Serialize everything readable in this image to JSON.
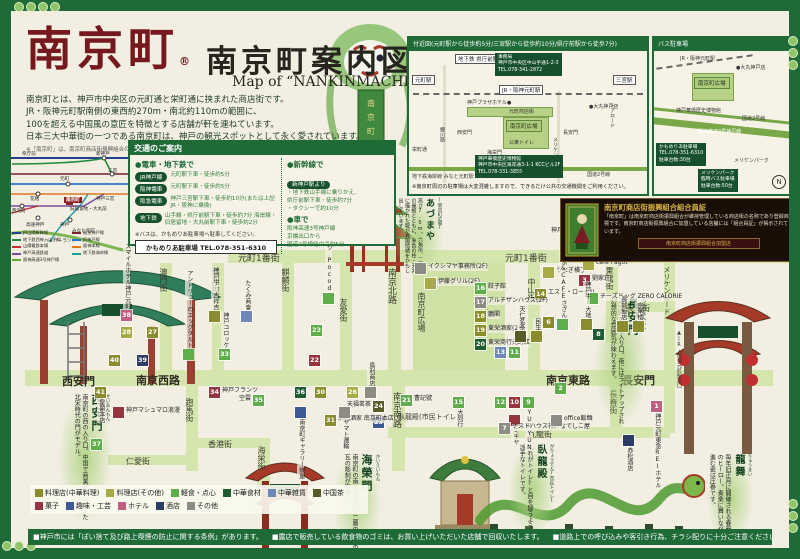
{
  "page": {
    "logo": "南京町",
    "reg": "®",
    "title": "南京町案内図",
    "subtitle": "Map of “NANKINMACHI”area",
    "description": [
      "南京町とは、神戸市中央区の元町通と栄町通に挟まれた商店街です。",
      "JR・阪神元町駅南側の東西約270m・南北約110mの範囲に、",
      "100を超える中国風の意匠を特徴とする店舗が軒を連ねています。",
      "日本三大中華街の一つである南京町は、神戸の観光スポットとして永く愛されています。"
    ],
    "footnote": "※「南京町」は、南京町商店街振興組合の登録商標です。"
  },
  "category_colors": {
    "chinese": "#8a8c2e",
    "other": "#a8aa48",
    "snack": "#5fae4b",
    "food": "#1f5c31",
    "goods": "#6f86b8",
    "tea": "#5a5c28",
    "sweets": "#963440",
    "hobby": "#3c5a96",
    "hotel": "#c06080",
    "liquor": "#2c3c64",
    "misc": "#8c8c84"
  },
  "vicinity": {
    "title": "付近図(元町駅から徒歩約5分/三宮駅から徒歩約10分/県庁前駅から徒歩7分)",
    "labels": [
      {
        "t": "地下鉄 県庁前駅",
        "x": 46,
        "y": 3,
        "cls": "boxw"
      },
      {
        "t": "元町駅",
        "x": 3,
        "y": 24,
        "cls": "boxw"
      },
      {
        "t": "三宮駅",
        "x": 204,
        "y": 24,
        "cls": "boxw"
      },
      {
        "t": "事務局\n神戸市中央区中山手通1-2-3\nTEL.078-341-2872",
        "x": 86,
        "y": 2,
        "cls": "darkbox"
      },
      {
        "t": "JR・阪神元町駅",
        "x": 90,
        "y": 34,
        "cls": "boxw"
      },
      {
        "t": "神戸プラザホテル●",
        "x": 58,
        "y": 48,
        "cls": "plain6"
      },
      {
        "t": "元町商店街",
        "x": 100,
        "y": 57,
        "cls": "plain6"
      },
      {
        "t": "●大丸神戸店",
        "x": 180,
        "y": 52,
        "cls": "plain6"
      },
      {
        "t": "西安門",
        "x": 48,
        "y": 78,
        "cls": "plain6"
      },
      {
        "t": "南京町広場",
        "x": 97,
        "y": 69,
        "cls": "greenbox"
      },
      {
        "t": "長安門",
        "x": 154,
        "y": 78,
        "cls": "plain6"
      },
      {
        "t": "公衆トイレ",
        "x": 100,
        "y": 88,
        "cls": "plain6"
      },
      {
        "t": "海栄門",
        "x": 78,
        "y": 98,
        "cls": "plain6"
      },
      {
        "t": "鯉川筋",
        "x": 30,
        "y": 76,
        "cls": "plain6",
        "v": 1
      },
      {
        "t": "メリケンロード",
        "x": 143,
        "y": 86,
        "cls": "plain6",
        "v": 1
      },
      {
        "t": "トアロード",
        "x": 200,
        "y": 52,
        "cls": "plain6",
        "v": 1
      },
      {
        "t": "栄町通",
        "x": 3,
        "y": 95,
        "cls": "plain6"
      },
      {
        "t": "地下鉄海岸線 みなと元町駅",
        "x": 3,
        "y": 122,
        "cls": "plain6"
      },
      {
        "t": "神戸華僑歴史博物館\n神戸市中央区海岸通3-1-1 KCCビル2F\nTEL.078-331-3855",
        "x": 66,
        "y": 104,
        "cls": "darkbox"
      },
      {
        "t": "国道2号線",
        "x": 178,
        "y": 120,
        "cls": "plain6"
      },
      {
        "t": "※南京町周辺の駐車場は大変混雑しますので、できるだけ公共の交通機関をご利用ください。",
        "x": 3,
        "y": 132,
        "cls": "note"
      }
    ]
  },
  "bus": {
    "title": "バス駐車場",
    "labels": [
      {
        "t": "JR・阪神元町駅",
        "x": 26,
        "y": 4,
        "cls": "plain6"
      },
      {
        "t": "●大丸神戸店",
        "x": 82,
        "y": 13,
        "cls": "plain6"
      },
      {
        "t": "南京町広場",
        "x": 40,
        "y": 26,
        "cls": "greenbox"
      },
      {
        "t": "神戸華僑歴史博物館",
        "x": 22,
        "y": 56,
        "cls": "plain6"
      },
      {
        "t": "国道2号線",
        "x": 88,
        "y": 64,
        "cls": "plain6"
      },
      {
        "t": "阪神高速3号神戸線",
        "x": 44,
        "y": 77,
        "cls": "bandlabel"
      },
      {
        "t": "かもめりあ駐車場\nTEL.078-351-6310\n駐車台数:30台",
        "x": 2,
        "y": 92,
        "cls": "darkbox"
      },
      {
        "t": "メリケンパーク",
        "x": 80,
        "y": 106,
        "cls": "plain6"
      },
      {
        "t": "メリケンパーク\n臨時バス駐車場\n駐車台数:50台",
        "x": 44,
        "y": 118,
        "cls": "darkbox"
      },
      {
        "t": "N",
        "x": 118,
        "y": 124,
        "cls": "compass"
      }
    ]
  },
  "transit": {
    "stations": [
      {
        "t": "県庁前",
        "x": 14,
        "y": 1
      },
      {
        "t": "新神戸",
        "x": 88,
        "y": 1
      },
      {
        "t": "三宮",
        "x": 100,
        "y": 18
      },
      {
        "t": "元町",
        "x": 52,
        "y": 26
      },
      {
        "t": "神戸三宮",
        "x": 88,
        "y": 46
      },
      {
        "t": "旧居留地・大丸前",
        "x": 62,
        "y": 56
      },
      {
        "t": "花隈",
        "x": 22,
        "y": 46
      },
      {
        "t": "西元町",
        "x": 4,
        "y": 58
      },
      {
        "t": "高速神戸",
        "x": 18,
        "y": 72
      },
      {
        "t": "神戸",
        "x": 52,
        "y": 72
      },
      {
        "t": "みなと元町",
        "x": 64,
        "y": 78
      },
      {
        "t": "ハーバーランド",
        "x": 36,
        "y": 88
      },
      {
        "t": "南京町",
        "x": 56,
        "y": 47,
        "red": 1
      }
    ],
    "legend": [
      {
        "c": "#24408e",
        "t": "JR山陽新幹線"
      },
      {
        "c": "#7a2030",
        "t": "阪急神戸線"
      },
      {
        "c": "#1e8a3c",
        "t": "地下鉄西神・山手線"
      },
      {
        "c": "#2878c8",
        "t": "JR神戸線"
      },
      {
        "c": "#c03030",
        "t": "山陽電鉄本線"
      },
      {
        "c": "#e07820",
        "t": "阪神本線"
      },
      {
        "c": "#7a4a9a",
        "t": "神戸高速鉄道"
      },
      {
        "c": "#18a0a0",
        "t": "地下鉄海岸線"
      },
      {
        "c": "#60a830",
        "t": "阪神高速3号神戸線"
      }
    ]
  },
  "transport": {
    "title": "交通のご案内",
    "train_header": "●電車・地下鉄で",
    "train_rows": [
      {
        "badge": "JR神戸線",
        "text": "元町駅下車・徒歩約5分"
      },
      {
        "badge": "阪神電車",
        "text": "元町駅下車・徒歩約5分"
      },
      {
        "badge": "阪急電車",
        "text": "神戸三宮駅下車・徒歩約10分(または上記JR・阪神に乗換)"
      },
      {
        "badge": "地下鉄",
        "text": "山手線・県庁前駅下車・徒歩約7分 海岸線・旧居留地・大丸前駅下車・徒歩約2分"
      }
    ],
    "bus_note": "※バスは、かもめりあ駐車場へ駐車してください。",
    "kamomeria": "かもめりあ駐車場 TEL.078-351-6310",
    "shinkansen_header": "●新幹線で",
    "shinkansen_badge": "新神戸駅より",
    "shinkansen_lines": [
      "・地下鉄山手線に乗りかえ、",
      "  県庁前駅下車・徒歩約7分",
      "・タクシーで約10分"
    ],
    "car_header": "●車で",
    "car_lines": [
      "阪神高速3号神戸線",
      "京橋出口から",
      "国道2号線経由で約5分"
    ]
  },
  "member": {
    "title": "南京町商店街振興組合組合員証",
    "body": "「南京町」は南京町商店街振興組合が維持管理している商店街の名称であり登録商標です。南京町商店街振興組合に加盟している店舗には「組合員証」が掲示されています。",
    "plaque": "南京町商店街振興組合加盟店"
  },
  "map": {
    "street_color": "#d5e5ae",
    "streets": [
      {
        "x": 228,
        "y": 250,
        "w": 566,
        "h": 13
      },
      {
        "x": 25,
        "y": 370,
        "w": 748,
        "h": 16
      },
      {
        "x": 388,
        "y": 427,
        "w": 282,
        "h": 11
      },
      {
        "x": 160,
        "y": 263,
        "w": 12,
        "h": 107
      },
      {
        "x": 212,
        "y": 263,
        "w": 12,
        "h": 107
      },
      {
        "x": 282,
        "y": 263,
        "w": 12,
        "h": 107
      },
      {
        "x": 340,
        "y": 263,
        "w": 12,
        "h": 107
      },
      {
        "x": 388,
        "y": 263,
        "w": 13,
        "h": 107
      },
      {
        "x": 528,
        "y": 263,
        "w": 12,
        "h": 107
      },
      {
        "x": 606,
        "y": 263,
        "w": 12,
        "h": 80
      },
      {
        "x": 618,
        "y": 302,
        "w": 52,
        "h": 10
      },
      {
        "x": 664,
        "y": 263,
        "w": 11,
        "h": 170
      },
      {
        "x": 392,
        "y": 386,
        "w": 13,
        "h": 85
      },
      {
        "x": 610,
        "y": 386,
        "w": 12,
        "h": 41
      },
      {
        "x": 186,
        "y": 386,
        "w": 12,
        "h": 85
      },
      {
        "x": 258,
        "y": 438,
        "w": 12,
        "h": 55
      },
      {
        "x": 108,
        "y": 455,
        "w": 78,
        "h": 10
      },
      {
        "x": 198,
        "y": 438,
        "w": 60,
        "h": 10
      }
    ],
    "street_labels": [
      {
        "t": "元町1番街",
        "x": 238,
        "y": 251,
        "s": 9
      },
      {
        "t": "元町1番街",
        "x": 505,
        "y": 251,
        "s": 9
      },
      {
        "t": "澳門街",
        "x": 158,
        "y": 268,
        "v": 1,
        "s": 8
      },
      {
        "t": "珠海街",
        "x": 210,
        "y": 268,
        "v": 1,
        "s": 8
      },
      {
        "t": "麒麟街",
        "x": 280,
        "y": 268,
        "v": 1,
        "s": 8
      },
      {
        "t": "友愛街",
        "x": 338,
        "y": 298,
        "v": 1,
        "s": 8
      },
      {
        "t": "南京北路",
        "x": 385,
        "y": 268,
        "v": 1,
        "s": 9
      },
      {
        "t": "南京町広場",
        "x": 416,
        "y": 292,
        "v": 1,
        "s": 8
      },
      {
        "t": "中山街",
        "x": 526,
        "y": 278,
        "v": 1,
        "s": 8
      },
      {
        "t": "東龍街",
        "x": 604,
        "y": 266,
        "v": 1,
        "s": 8
      },
      {
        "t": "長城街",
        "x": 626,
        "y": 303,
        "s": 8
      },
      {
        "t": "メリケンロード",
        "x": 662,
        "y": 266,
        "v": 1,
        "s": 7
      },
      {
        "t": "西安門",
        "x": 62,
        "y": 373,
        "s": 11,
        "b": 1
      },
      {
        "t": "南京西路",
        "x": 136,
        "y": 372,
        "s": 11,
        "b": 1
      },
      {
        "t": "南京東路",
        "x": 546,
        "y": 372,
        "s": 11,
        "b": 1
      },
      {
        "t": "長安門",
        "x": 622,
        "y": 372,
        "s": 11,
        "b": 1
      },
      {
        "t": "南京南路",
        "x": 390,
        "y": 392,
        "v": 1,
        "s": 9
      },
      {
        "t": "九龍街",
        "x": 528,
        "y": 429,
        "s": 8
      },
      {
        "t": "長春街",
        "x": 608,
        "y": 390,
        "v": 1,
        "s": 8
      },
      {
        "t": "跑馬街",
        "x": 184,
        "y": 398,
        "v": 1,
        "s": 8
      },
      {
        "t": "仁愛街",
        "x": 126,
        "y": 456,
        "s": 8
      },
      {
        "t": "香港街",
        "x": 208,
        "y": 439,
        "s": 8
      },
      {
        "t": "海栄街",
        "x": 256,
        "y": 446,
        "v": 1,
        "s": 8
      },
      {
        "t": "臥龍殿(市民トイレ)",
        "x": 398,
        "y": 412,
        "s": 7
      },
      {
        "t": "▲JR・阪神元町駅東口",
        "x": 676,
        "y": 330,
        "v": 1,
        "s": 5
      },
      {
        "t": "海栄門",
        "x": 400,
        "y": 533,
        "s": 9
      }
    ],
    "gates": [
      {
        "kana": "せいあんもん",
        "name": "西安門",
        "desc": "南京町の西の入り口。中国で商業が最も栄えた北宋時代の門がモデル。"
      },
      {
        "kana": "ちょうあんもん",
        "name": "長安門",
        "desc": "南京町の東の入り口。夜にはライトアップされ幻想的な雰囲気が味わえます。"
      },
      {
        "kana": "かいえいもん",
        "name": "海榮門",
        "desc": "南京町の南の入り口。二層の屋根の瓦の彫刻が豪華!"
      },
      {
        "kana": "(南京町広場)",
        "name": "あづまや",
        "desc": "高さ7.5m。六角形、二層式の屋根とともに、朱色の柱・天井に描かれた龍が異国情緒をかもし出しています。"
      },
      {
        "kana": "がりょうでん(市民トイレ)",
        "name": "臥龍殿",
        "desc": "これがトイレ?と目を疑うような派手なトイレです。"
      },
      {
        "kana": "りゅうまい",
        "name": "龍舞",
        "desc": "毎年旧正月に開催される春節祭のヒーロー。奏楽に舞いながら進む姿は圧巻です。"
      }
    ],
    "markers": [
      {
        "n": "38",
        "c": "hotel",
        "x": 126,
        "y": 315,
        "t": "スマイルホテル神戸元町",
        "p": "up"
      },
      {
        "c": "chinese",
        "x": 214,
        "y": 316,
        "t": "神戸牛 吉祥吉",
        "p": "up"
      },
      {
        "c": "goods",
        "x": 246,
        "y": 316,
        "t": "たくみ商會",
        "p": "up"
      },
      {
        "n": "27",
        "c": "chinese",
        "x": 152,
        "y": 332
      },
      {
        "n": "28",
        "c": "other",
        "x": 126,
        "y": 332
      },
      {
        "n": "33",
        "c": "snack",
        "x": 224,
        "y": 354,
        "t": "神戸コロッケ",
        "p": "up"
      },
      {
        "c": "snack",
        "x": 188,
        "y": 354,
        "t": "アンドリューのエッグタルト",
        "p": "up"
      },
      {
        "n": "40",
        "c": "chinese",
        "x": 114,
        "y": 360
      },
      {
        "n": "39",
        "c": "liquor",
        "x": 142,
        "y": 360
      },
      {
        "n": "23",
        "c": "snack",
        "x": 316,
        "y": 330
      },
      {
        "c": "snack",
        "x": 328,
        "y": 298,
        "t": "チーズドッグ Pocod",
        "p": "up"
      },
      {
        "n": "22",
        "c": "sweets",
        "x": 314,
        "y": 360
      },
      {
        "c": "misc",
        "x": 420,
        "y": 268,
        "t": "イクシマヤ事務所(2F)",
        "p": "right"
      },
      {
        "c": "other",
        "x": 430,
        "y": 283,
        "t": "伊藤グリル(2F)",
        "p": "right"
      },
      {
        "c": "other",
        "x": 548,
        "y": 272,
        "t": "うなぎ横丁",
        "p": "right"
      },
      {
        "c": "other",
        "x": 588,
        "y": 264,
        "t": "cafe Pagot",
        "p": "right"
      },
      {
        "n": "3",
        "c": "sweets",
        "x": 584,
        "y": 280,
        "t": "劉家荘",
        "p": "right"
      },
      {
        "n": "5",
        "c": "hotel",
        "x": 606,
        "y": 232,
        "t": "神戸プラザホテル",
        "p": "left"
      },
      {
        "n": "14",
        "c": "chinese",
        "x": 540,
        "y": 294,
        "t": "エスト・ローゼル",
        "p": "right"
      },
      {
        "n": "16",
        "c": "snack",
        "x": 480,
        "y": 288,
        "t": "餃子館",
        "p": "right"
      },
      {
        "n": "17",
        "c": "misc",
        "x": 480,
        "y": 302,
        "t": "アルチザンハウス(2F)",
        "p": "right"
      },
      {
        "n": "18",
        "c": "chinese",
        "x": 480,
        "y": 316,
        "t": "鵬閣",
        "p": "right"
      },
      {
        "n": "19",
        "c": "chinese",
        "x": 480,
        "y": 330,
        "t": "東栄酒家(2F)",
        "p": "right"
      },
      {
        "n": "20",
        "c": "food",
        "x": 480,
        "y": 344,
        "t": "東栄商行元町店",
        "p": "right"
      },
      {
        "c": "tea",
        "x": 520,
        "y": 336,
        "t": "天仁茗茶",
        "p": "up"
      },
      {
        "c": "chinese",
        "x": 536,
        "y": 336,
        "t": "民生",
        "p": "up"
      },
      {
        "n": "13",
        "c": "goods",
        "x": 500,
        "y": 352
      },
      {
        "n": "11",
        "c": "snack",
        "x": 514,
        "y": 352
      },
      {
        "n": "8",
        "c": "food",
        "x": 598,
        "y": 334
      },
      {
        "n": "6",
        "c": "chinese",
        "x": 548,
        "y": 322
      },
      {
        "c": "snack",
        "x": 562,
        "y": 324,
        "t": "かき氷&CAFEさざん",
        "p": "up"
      },
      {
        "c": "snack",
        "x": 592,
        "y": 298,
        "t": "チーズドッグ ZERO CALORIE",
        "p": "right"
      },
      {
        "c": "chinese",
        "x": 586,
        "y": 324,
        "t": "神戸牛 大地",
        "p": "up"
      },
      {
        "c": "chinese",
        "x": 622,
        "y": 326,
        "t": "長城飯店",
        "p": "up"
      },
      {
        "c": "chinese",
        "x": 638,
        "y": 326,
        "t": "京華楼",
        "p": "up"
      },
      {
        "n": "2",
        "c": "snack",
        "x": 560,
        "y": 388
      },
      {
        "n": "1",
        "c": "hotel",
        "x": 656,
        "y": 406,
        "t": "神戸元町東急REIホテル",
        "p": "down"
      },
      {
        "n": "21",
        "c": "snack",
        "x": 406,
        "y": 400,
        "t": "曹記號",
        "p": "right"
      },
      {
        "n": "15",
        "c": "snack",
        "x": 458,
        "y": 402,
        "t": "大同行",
        "p": "down"
      },
      {
        "n": "12",
        "c": "snack",
        "x": 500,
        "y": 402
      },
      {
        "n": "10",
        "c": "sweets",
        "x": 514,
        "y": 402
      },
      {
        "n": "9",
        "c": "snack",
        "x": 528,
        "y": 402,
        "t": "YUNYUN",
        "p": "down"
      },
      {
        "c": "sweets",
        "x": 514,
        "y": 420,
        "t": "ミキヤ",
        "p": "down"
      },
      {
        "n": "24",
        "c": "tea",
        "x": 378,
        "y": 406,
        "t": "天福茗茶",
        "p": "left"
      },
      {
        "n": "25",
        "c": "hobby",
        "x": 378,
        "y": 422
      },
      {
        "n": "34",
        "c": "sweets",
        "x": 214,
        "y": 392,
        "t": "神戸フランツ",
        "p": "right"
      },
      {
        "n": "41",
        "c": "chinese",
        "x": 100,
        "y": 392,
        "t": "皇蘭本店",
        "p": "down"
      },
      {
        "c": "sweets",
        "x": 118,
        "y": 412,
        "t": "神戸マシュマロ浪漫",
        "p": "right"
      },
      {
        "n": "35",
        "c": "snack",
        "x": 258,
        "y": 400,
        "t": "空雲",
        "p": "left"
      },
      {
        "n": "36",
        "c": "food",
        "x": 300,
        "y": 392
      },
      {
        "n": "30",
        "c": "chinese",
        "x": 320,
        "y": 392
      },
      {
        "n": "31",
        "c": "chinese",
        "x": 330,
        "y": 420,
        "t": "順記酒家 南京町本店",
        "p": "right"
      },
      {
        "n": "37",
        "c": "snack",
        "x": 96,
        "y": 444
      },
      {
        "c": "hobby",
        "x": 300,
        "y": 412,
        "t": "南京町ギャラリー蝶屋",
        "p": "down"
      },
      {
        "c": "misc",
        "x": 344,
        "y": 412,
        "t": "ヤマト運輸",
        "p": "down"
      },
      {
        "c": "misc",
        "x": 370,
        "y": 392,
        "t": "鳥利商店",
        "p": "up"
      },
      {
        "n": "26",
        "c": "other",
        "x": 352,
        "y": 392
      },
      {
        "n": "7",
        "c": "misc",
        "x": 504,
        "y": 428,
        "t": "ゲストハウス神戸なでしこ屋",
        "p": "right"
      },
      {
        "c": "misc",
        "x": 556,
        "y": 420,
        "t": "office飯麺",
        "p": "right"
      },
      {
        "c": "liquor",
        "x": 628,
        "y": 440,
        "t": "赤松酒店",
        "p": "down"
      }
    ],
    "legend": [
      {
        "t": "料理店(中華料理)",
        "c": "#8a8c2e"
      },
      {
        "t": "料理店(その他)",
        "c": "#a8aa48"
      },
      {
        "t": "軽食・点心",
        "c": "#5fae4b"
      },
      {
        "t": "中華食材",
        "c": "#1f5c31"
      },
      {
        "t": "中華雑貨",
        "c": "#6f86b8"
      },
      {
        "t": "中国茶",
        "c": "#5a5c28"
      },
      {
        "t": "菓子",
        "c": "#963440"
      },
      {
        "t": "趣味・工芸",
        "c": "#3c5a96"
      },
      {
        "t": "ホテル",
        "c": "#c06080"
      },
      {
        "t": "酒店",
        "c": "#2c3c64"
      },
      {
        "t": "その他",
        "c": "#8c8c84"
      }
    ]
  },
  "notes": {
    "items": [
      "■神戸市には「ぽい捨て及び路上喫煙の防止に関する条例」があります。",
      "■露店で販売している飲食物のゴミは、お買い上げいただいた店舗で回収いたします。",
      "■道路上での呼び込みや客引き行為、チラシ配りに十分ご注意ください。"
    ]
  }
}
